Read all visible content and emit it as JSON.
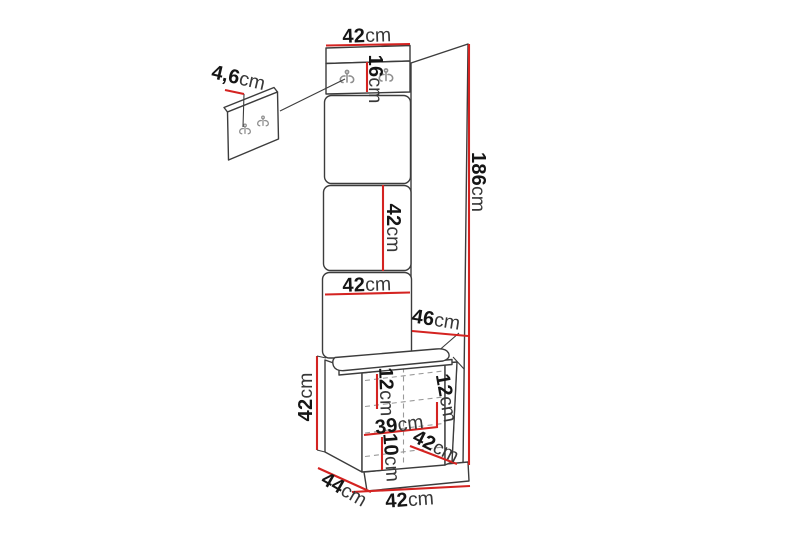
{
  "canvas": {
    "width": 800,
    "height": 533,
    "background": "#ffffff"
  },
  "colors": {
    "background": "#ffffff",
    "outline": "#3c3c3c",
    "dimension_line": "#d42321",
    "seam": "#9a9a9a",
    "hook": "#8f8f8f",
    "number_text": "#151515",
    "unit_text": "#383838"
  },
  "dimensions": {
    "panel_top_width": {
      "value": "42",
      "unit": "cm"
    },
    "hook_board_height": {
      "value": "16",
      "unit": "cm"
    },
    "hook_panel_depth": {
      "value": "4,6",
      "unit": "cm"
    },
    "total_height": {
      "value": "186",
      "unit": "cm"
    },
    "middle_panel_height": {
      "value": "42",
      "unit": "cm"
    },
    "middle_panel_width": {
      "value": "42",
      "unit": "cm"
    },
    "side_wall_depth": {
      "value": "46",
      "unit": "cm"
    },
    "bench_height": {
      "value": "42",
      "unit": "cm"
    },
    "bench_front_top_height": {
      "value": "12",
      "unit": "cm"
    },
    "bench_side_top_height": {
      "value": "12",
      "unit": "cm"
    },
    "bench_front_width": {
      "value": "39",
      "unit": "cm"
    },
    "bench_plinth_height": {
      "value": "10",
      "unit": "cm"
    },
    "bench_seat_depth": {
      "value": "42",
      "unit": "cm"
    },
    "bench_depth": {
      "value": "44",
      "unit": "cm"
    },
    "bench_width": {
      "value": "42",
      "unit": "cm"
    }
  }
}
